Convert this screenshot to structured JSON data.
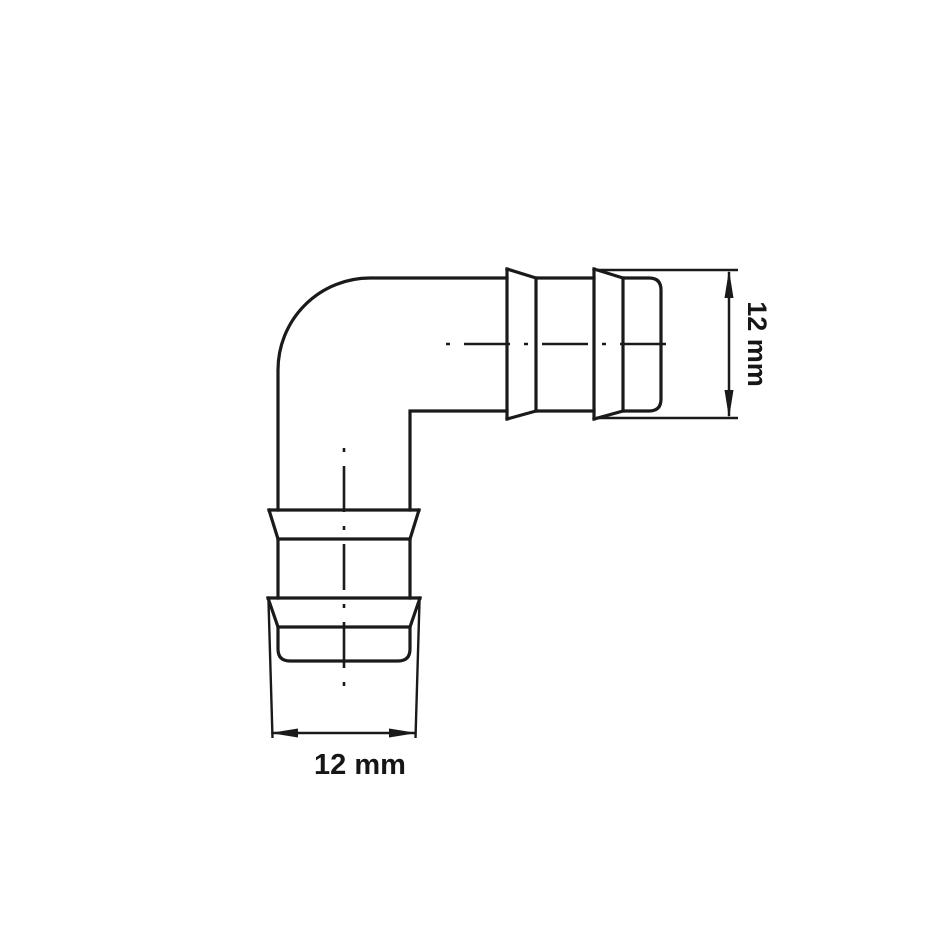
{
  "drawing": {
    "subject": "90-degree elbow hose barb connector",
    "dimensions": {
      "right": {
        "label": "12 mm",
        "orientation": "vertical"
      },
      "bottom": {
        "label": "12 mm",
        "orientation": "horizontal"
      }
    },
    "style": {
      "line_color": "#1a1a1a",
      "background": "#ffffff"
    }
  }
}
